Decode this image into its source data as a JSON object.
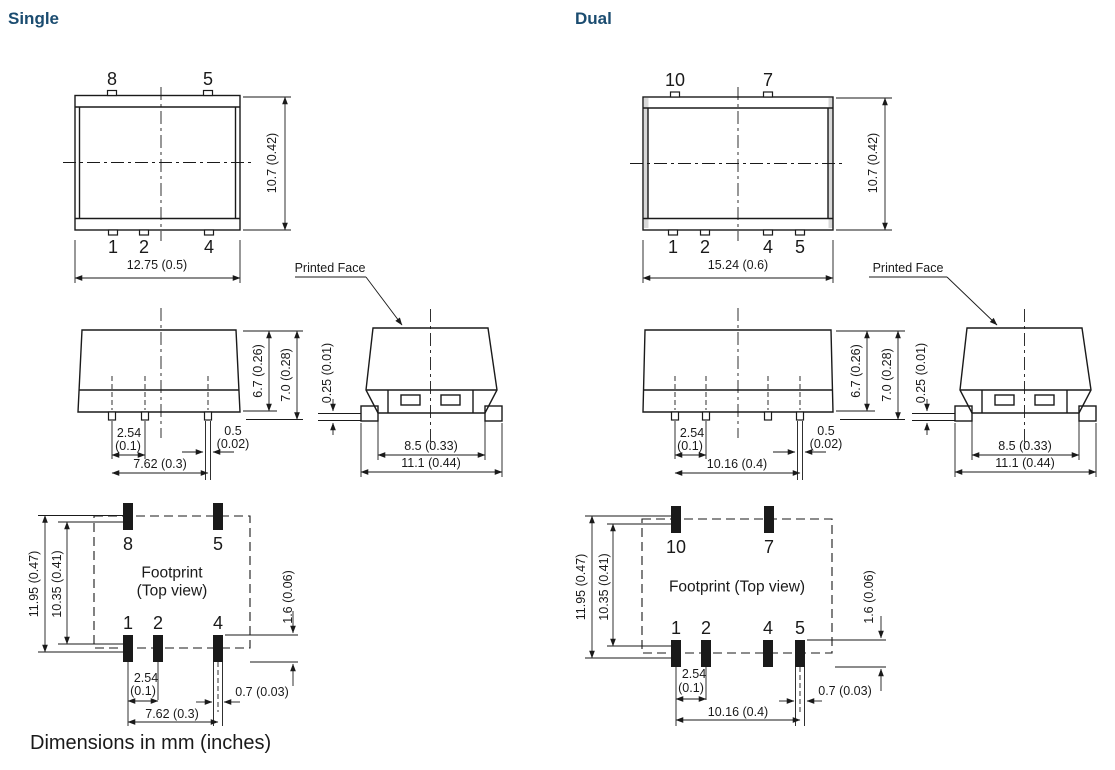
{
  "titles": {
    "single": "Single",
    "dual": "Dual"
  },
  "note": "Dimensions in mm (inches)",
  "colors": {
    "heading": "#1b4c70",
    "ink": "#1a1a1a"
  },
  "single": {
    "top_view": {
      "pins_top": [
        "8",
        "5"
      ],
      "pins_bottom": [
        "1",
        "2",
        "4"
      ],
      "width": "12.75 (0.5)",
      "height": "10.7 (0.42)"
    },
    "side_view": {
      "case_height": "6.7 (0.26)",
      "overall_height": "7.0 (0.28)",
      "pitch": "2.54",
      "pitch_in": "(0.1)",
      "pin_width": "0.5",
      "pin_width_in": "(0.02)",
      "span": "7.62 (0.3)"
    },
    "end_view": {
      "printed_face": "Printed Face",
      "standoff": "0.25 (0.01)",
      "body_width": "8.5 (0.33)",
      "overall_width": "11.1 (0.44)"
    },
    "footprint": {
      "title_line1": "Footprint",
      "title_line2": "(Top view)",
      "pads_top": [
        "8",
        "5"
      ],
      "pads_bottom": [
        "1",
        "2",
        "4"
      ],
      "outer_height": "11.95 (0.47)",
      "inner_height": "10.35 (0.41)",
      "pad_length": "1.6 (0.06)",
      "pitch": "2.54",
      "pitch_in": "(0.1)",
      "pad_width": "0.7 (0.03)",
      "span": "7.62 (0.3)"
    }
  },
  "dual": {
    "top_view": {
      "pins_top": [
        "10",
        "7"
      ],
      "pins_bottom": [
        "1",
        "2",
        "4",
        "5"
      ],
      "width": "15.24 (0.6)",
      "height": "10.7 (0.42)"
    },
    "side_view": {
      "case_height": "6.7 (0.26)",
      "overall_height": "7.0 (0.28)",
      "pitch": "2.54",
      "pitch_in": "(0.1)",
      "pin_width": "0.5",
      "pin_width_in": "(0.02)",
      "span": "10.16 (0.4)"
    },
    "end_view": {
      "printed_face": "Printed Face",
      "standoff": "0.25 (0.01)",
      "body_width": "8.5 (0.33)",
      "overall_width": "11.1 (0.44)"
    },
    "footprint": {
      "title": "Footprint (Top view)",
      "pads_top": [
        "10",
        "7"
      ],
      "pads_bottom": [
        "1",
        "2",
        "4",
        "5"
      ],
      "outer_height": "11.95 (0.47)",
      "inner_height": "10.35 (0.41)",
      "pad_length": "1.6 (0.06)",
      "pitch": "2.54",
      "pitch_in": "(0.1)",
      "pad_width": "0.7 (0.03)",
      "span": "10.16 (0.4)"
    }
  }
}
